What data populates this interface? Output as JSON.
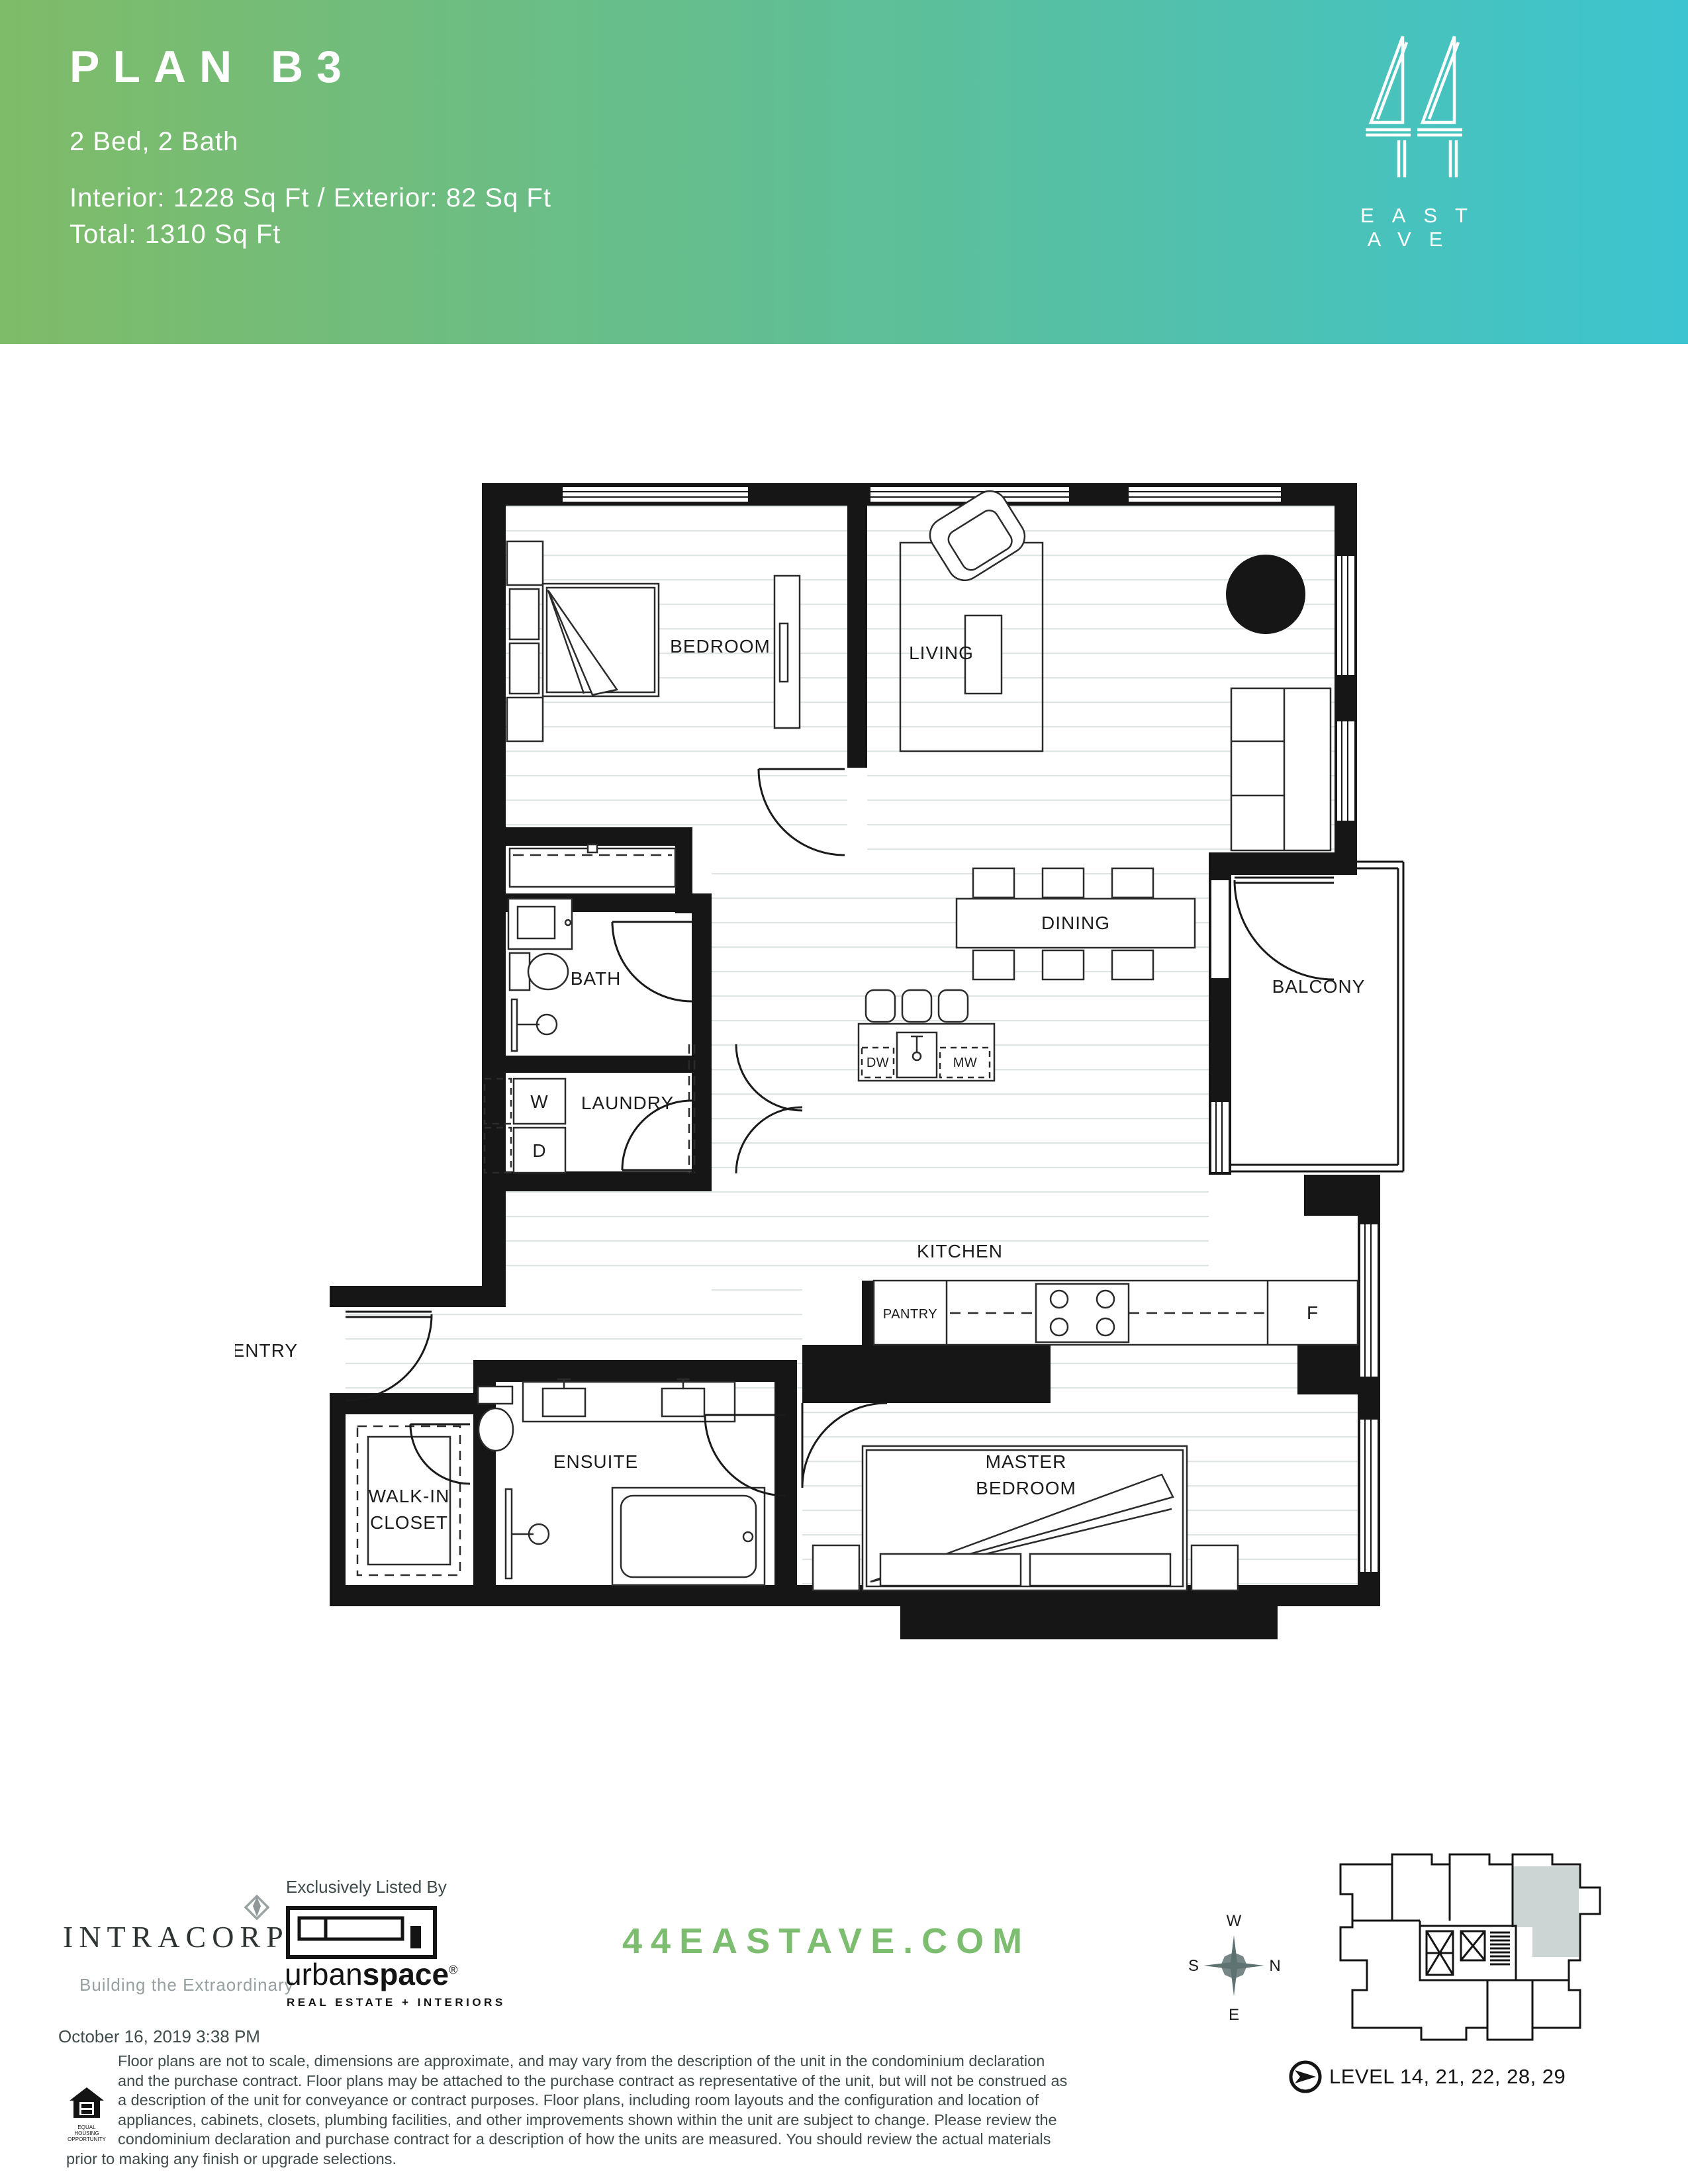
{
  "header": {
    "title": "PLAN B3",
    "subtitle": "2 Bed, 2 Bath",
    "area_line": "Interior: 1228 Sq Ft / Exterior: 82 Sq Ft",
    "total_line": "Total: 1310 Sq Ft",
    "brand_number": "44",
    "brand_name": "EAST AVE",
    "gradient_left": "#7fbb68",
    "gradient_right": "#3cc4d0"
  },
  "plan": {
    "labels": {
      "bedroom": "BEDROOM",
      "living": "LIVING",
      "dining": "DINING",
      "bath": "BATH",
      "balcony": "BALCONY",
      "laundry": "LAUNDRY",
      "washer": "W",
      "dryer": "D",
      "kitchen": "KITCHEN",
      "pantry": "PANTRY",
      "fridge": "F",
      "dishwasher": "DW",
      "microwave": "MW",
      "entry": "ENTRY",
      "master_line1": "MASTER",
      "master_line2": "BEDROOM",
      "walkin_line1": "WALK-IN",
      "walkin_line2": "CLOSET",
      "ensuite": "ENSUITE"
    },
    "wall_color": "#161616",
    "floor_line_color": "#dfe4e4"
  },
  "footer": {
    "developer": "INTRACORP",
    "developer_tagline": "Building the Extraordinary",
    "listed_by": "Exclusively Listed By",
    "brokerage_light": "urban",
    "brokerage_bold": "space",
    "brokerage_reg": "®",
    "brokerage_sub": "REAL ESTATE + INTERIORS",
    "website": "44EASTAVE.COM",
    "website_color": "#7cbd6f",
    "compass": {
      "top": "W",
      "left": "S",
      "right": "N",
      "bottom": "E"
    },
    "level_label": "LEVEL 14, 21, 22, 28, 29",
    "date": "October 16, 2019 3:38 PM",
    "eho_line1": "EQUAL HOUSING",
    "eho_line2": "OPPORTUNITY",
    "disclaimer": "Floor plans are not to scale, dimensions are approximate, and may vary from the description of the unit in the condominium declaration and the purchase contract. Floor plans may be attached to the purchase contract as representative of the unit, but will not be construed as a description of the unit for conveyance or contract purposes.  Floor plans, including room layouts and the configuration and location of appliances, cabinets, closets, plumbing facilities, and other improvements shown within the unit are subject to change.  Please review the condominium declaration and purchase contract for a description of how the units are measured.  You should review the actual materials prior to making any finish or upgrade selections."
  }
}
